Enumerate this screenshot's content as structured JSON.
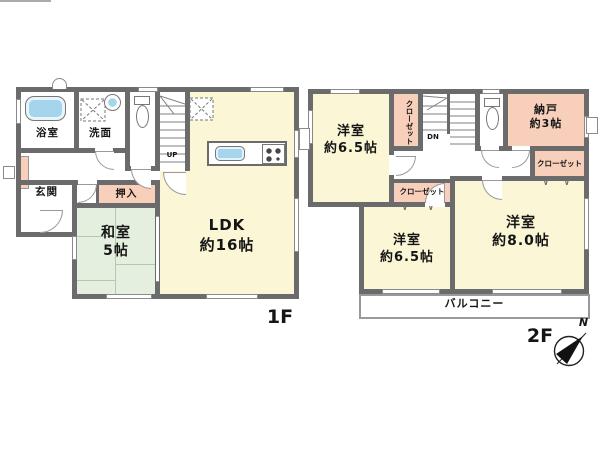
{
  "colors": {
    "wall": "#6b6b6b",
    "room_yellow": "#faf6d6",
    "tatami_green": "#e4efdf",
    "closet_pink": "#f7cfba",
    "water_blue": "#a5d5ed"
  },
  "f1": {
    "label": "1F",
    "bath": "浴室",
    "washroom": "洗面",
    "entrance": "玄関",
    "oshiire": "押入",
    "tatami_room": [
      "和室",
      "5帖"
    ],
    "ldk": [
      "LDK",
      "約16帖"
    ],
    "stairs": "UP"
  },
  "f2": {
    "label": "2F",
    "bedroom_nw": [
      "洋室",
      "約6.5帖"
    ],
    "closet_nw": "クローゼット",
    "stairs": "DN",
    "storage": [
      "納戸",
      "約3帖"
    ],
    "closet_e": "クローゼット",
    "closet_mid": "クローゼット",
    "bedroom_s": [
      "洋室",
      "約6.5帖"
    ],
    "bedroom_se": [
      "洋室",
      "約8.0帖"
    ],
    "balcony": "バルコニー"
  },
  "marks": {
    "folding_door": "∨"
  },
  "compass": {
    "north": "N"
  }
}
